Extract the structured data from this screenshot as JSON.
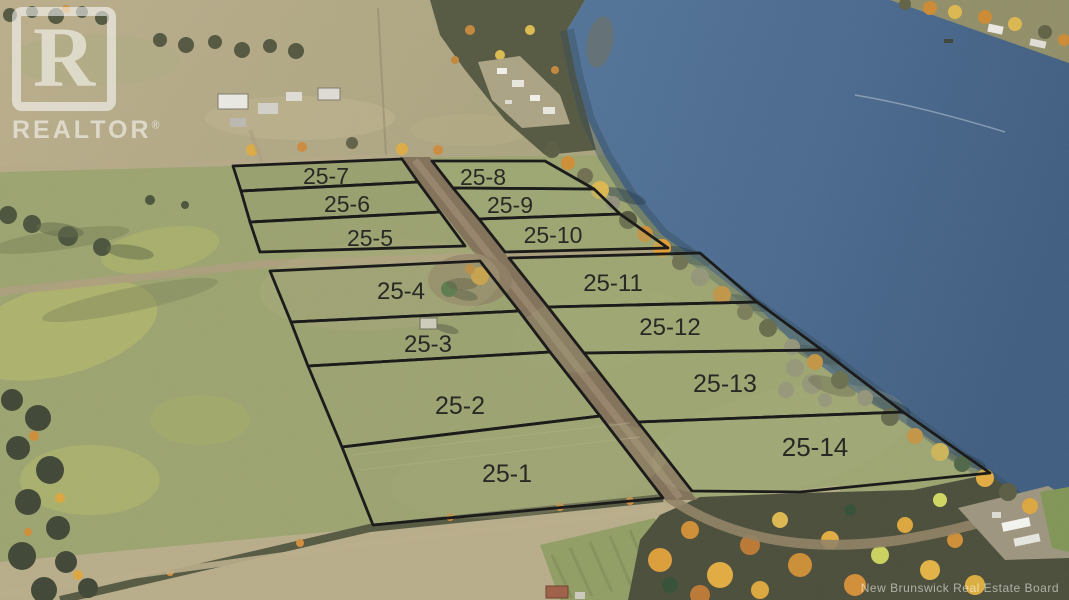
{
  "lots": [
    {
      "label": "25-1"
    },
    {
      "label": "25-2"
    },
    {
      "label": "25-3"
    },
    {
      "label": "25-4"
    },
    {
      "label": "25-5"
    },
    {
      "label": "25-6"
    },
    {
      "label": "25-7"
    },
    {
      "label": "25-8"
    },
    {
      "label": "25-9"
    },
    {
      "label": "25-10"
    },
    {
      "label": "25-11"
    },
    {
      "label": "25-12"
    },
    {
      "label": "25-13"
    },
    {
      "label": "25-14"
    }
  ],
  "watermarks": {
    "realtor": {
      "letter": "R",
      "word": "REALTOR",
      "registered": "®"
    },
    "credit": "New Brunswick Real Estate Board"
  },
  "colors": {
    "water": "#47688e",
    "water_deep": "#3a587c",
    "field_olive": "#98a06c",
    "field_tan": "#b7ab88",
    "forest_dark": "#454934",
    "autumn_orange": "#d1902f",
    "autumn_yellow": "#d9b44a",
    "road_brown": "#7e6d55",
    "boundary": "#101010",
    "label_text": "#1d1d1a",
    "watermark_white": "#ffffff"
  }
}
